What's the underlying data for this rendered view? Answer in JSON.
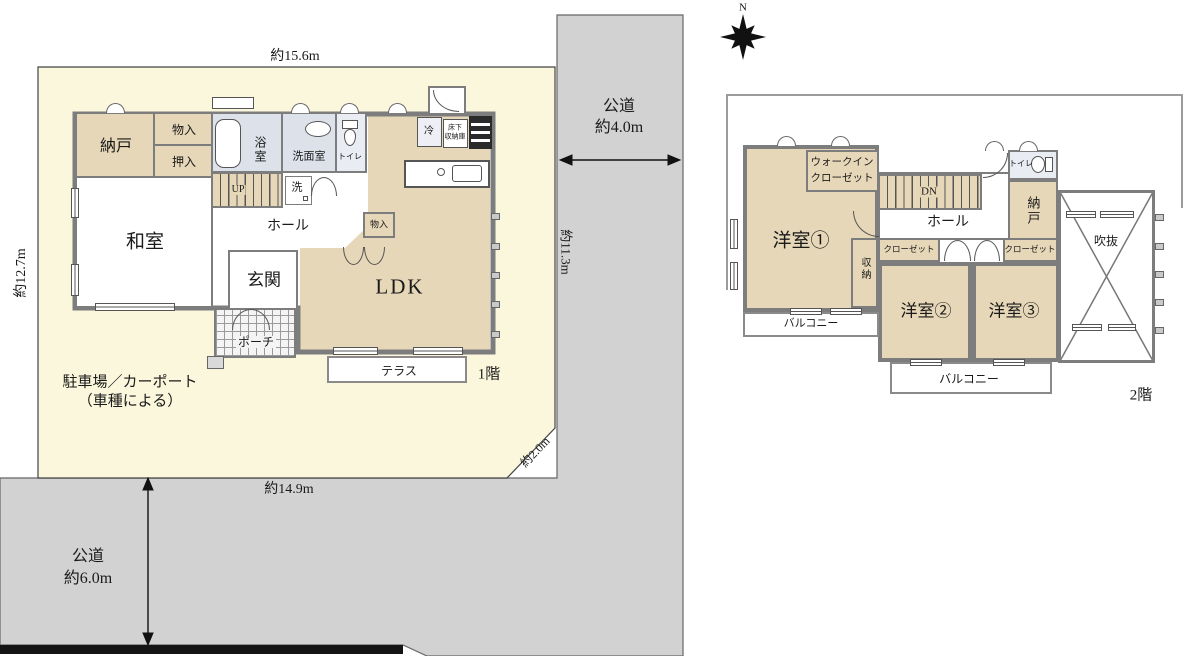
{
  "colors": {
    "site": "#FAF7DC",
    "road": "#D2D2D2",
    "room_tan": "#E6D7B8",
    "wet_area": "#DCE1EA",
    "wall": "#7D7D7D"
  },
  "compass": {
    "north_label": "N"
  },
  "site": {
    "dim_top": "約15.6m",
    "dim_left": "約12.7m",
    "dim_right": "約11.3m",
    "dim_bottom": "約14.9m",
    "dim_corner": "約2.0m",
    "road_right_line1": "公道",
    "road_right_line2": "約4.0m",
    "road_bottom_line1": "公道",
    "road_bottom_line2": "約6.0m",
    "parking_line1": "駐車場／カーポート",
    "parking_line2": "（車種による）"
  },
  "floor1": {
    "floor_label": "1階",
    "nando": "納戸",
    "monoire": "物入",
    "oshiire": "押入",
    "washitsu": "和室",
    "bath": "浴室",
    "senmen": "洗面室",
    "toilet": "トイレ",
    "washer": "洗",
    "stairs": "UP",
    "hall": "ホール",
    "genkan": "玄関",
    "porch": "ポーチ",
    "monoire_ldk": "物入",
    "ldk": "LDK",
    "fridge": "冷",
    "floor_storage_1": "床下",
    "floor_storage_2": "収納庫",
    "terrace": "テラス"
  },
  "floor2": {
    "floor_label": "2階",
    "yoshitsu1": "洋室①",
    "wic_1": "ウォークイン",
    "wic_2": "クローゼット",
    "stairs": "DN",
    "hall": "ホール",
    "toilet": "トイレ",
    "nando": "納戸",
    "closet_left": "クローゼット",
    "closet_right": "クローゼット",
    "shunou": "収納",
    "yoshitsu2": "洋室②",
    "yoshitsu3": "洋室③",
    "void": "吹抜",
    "balcony_left": "バルコニー",
    "balcony_bottom": "バルコニー"
  }
}
